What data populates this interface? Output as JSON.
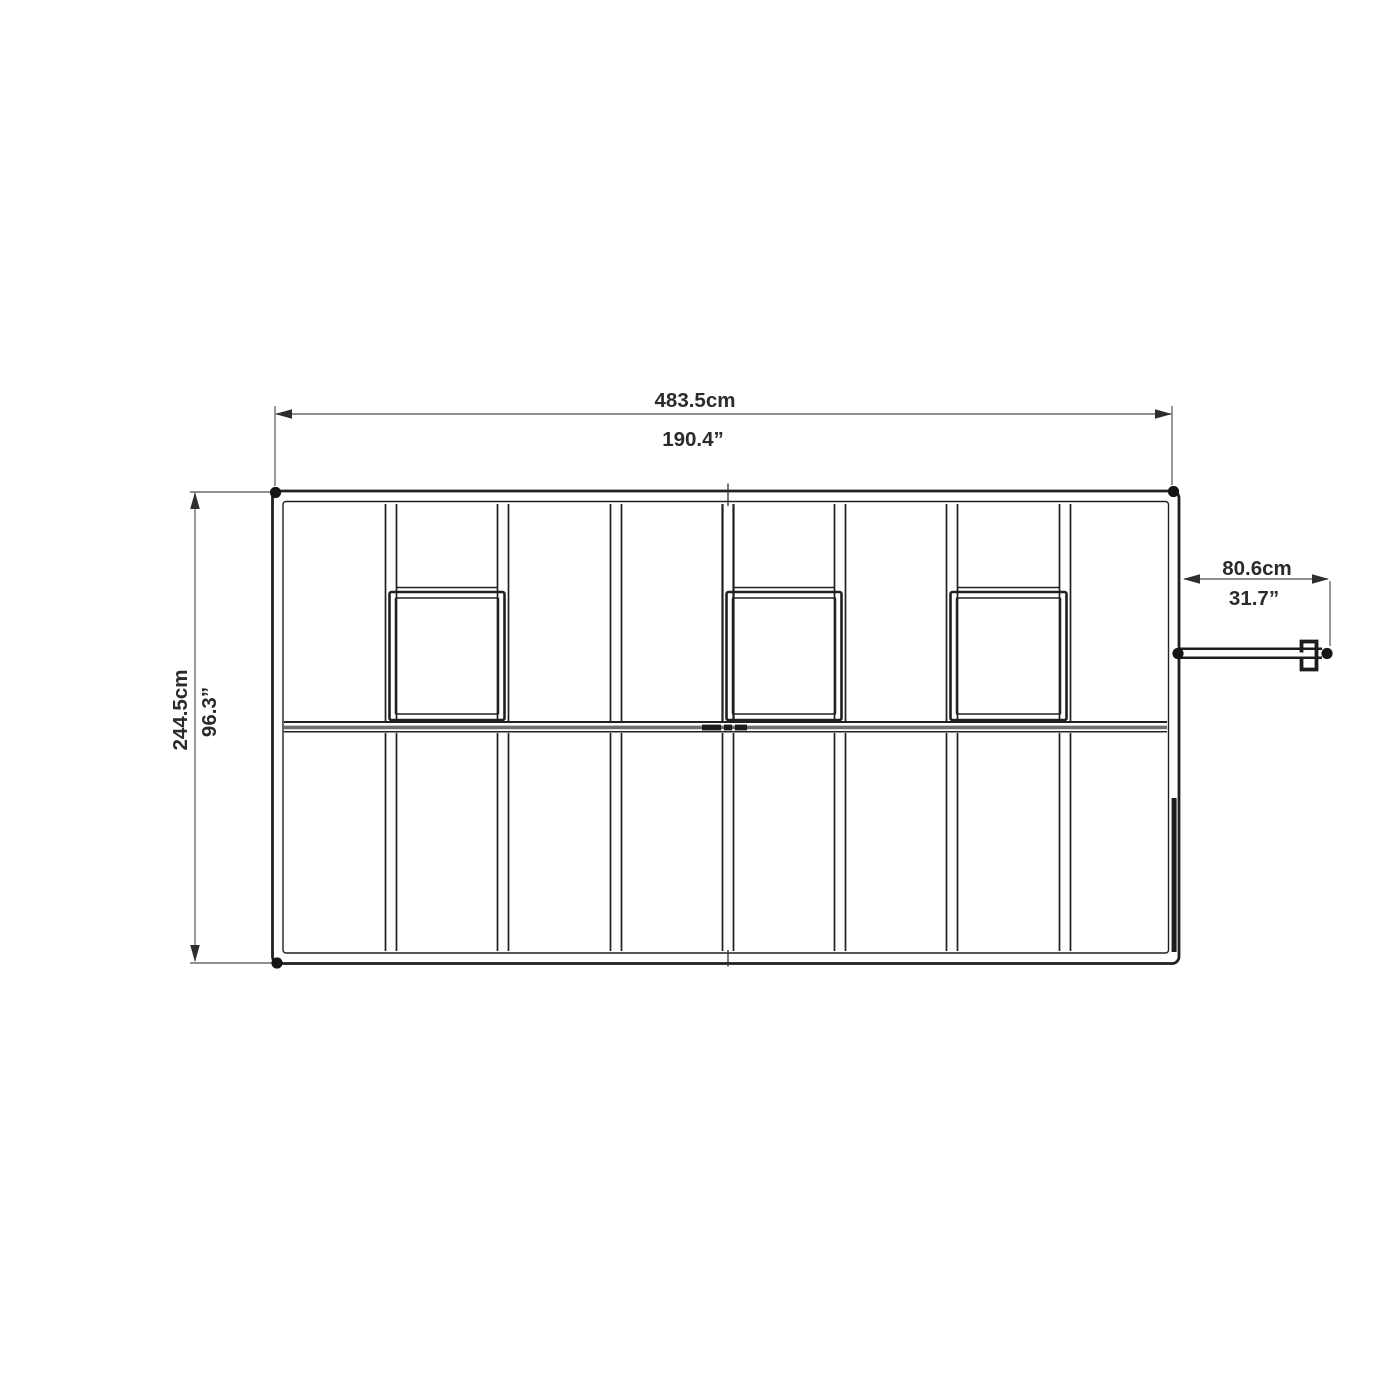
{
  "diagram": {
    "type": "greenhouse-top-view-dimension-drawing",
    "dimensions": {
      "overall_width": {
        "metric": "483.5cm",
        "imperial": "190.4”"
      },
      "overall_depth": {
        "metric": "244.5cm",
        "imperial": "96.3”"
      },
      "door_width": {
        "metric": "80.6cm",
        "imperial": "31.7”"
      }
    },
    "features": {
      "roof_panel_bays": 8,
      "roof_vents": 3,
      "corner_markers": 3,
      "door_hinge_markers": 2
    },
    "colors": {
      "structure_line": "#231f20",
      "dimension_line": "#4d4d4d",
      "label_text": "#2b2b2b",
      "background": "#ffffff"
    }
  }
}
